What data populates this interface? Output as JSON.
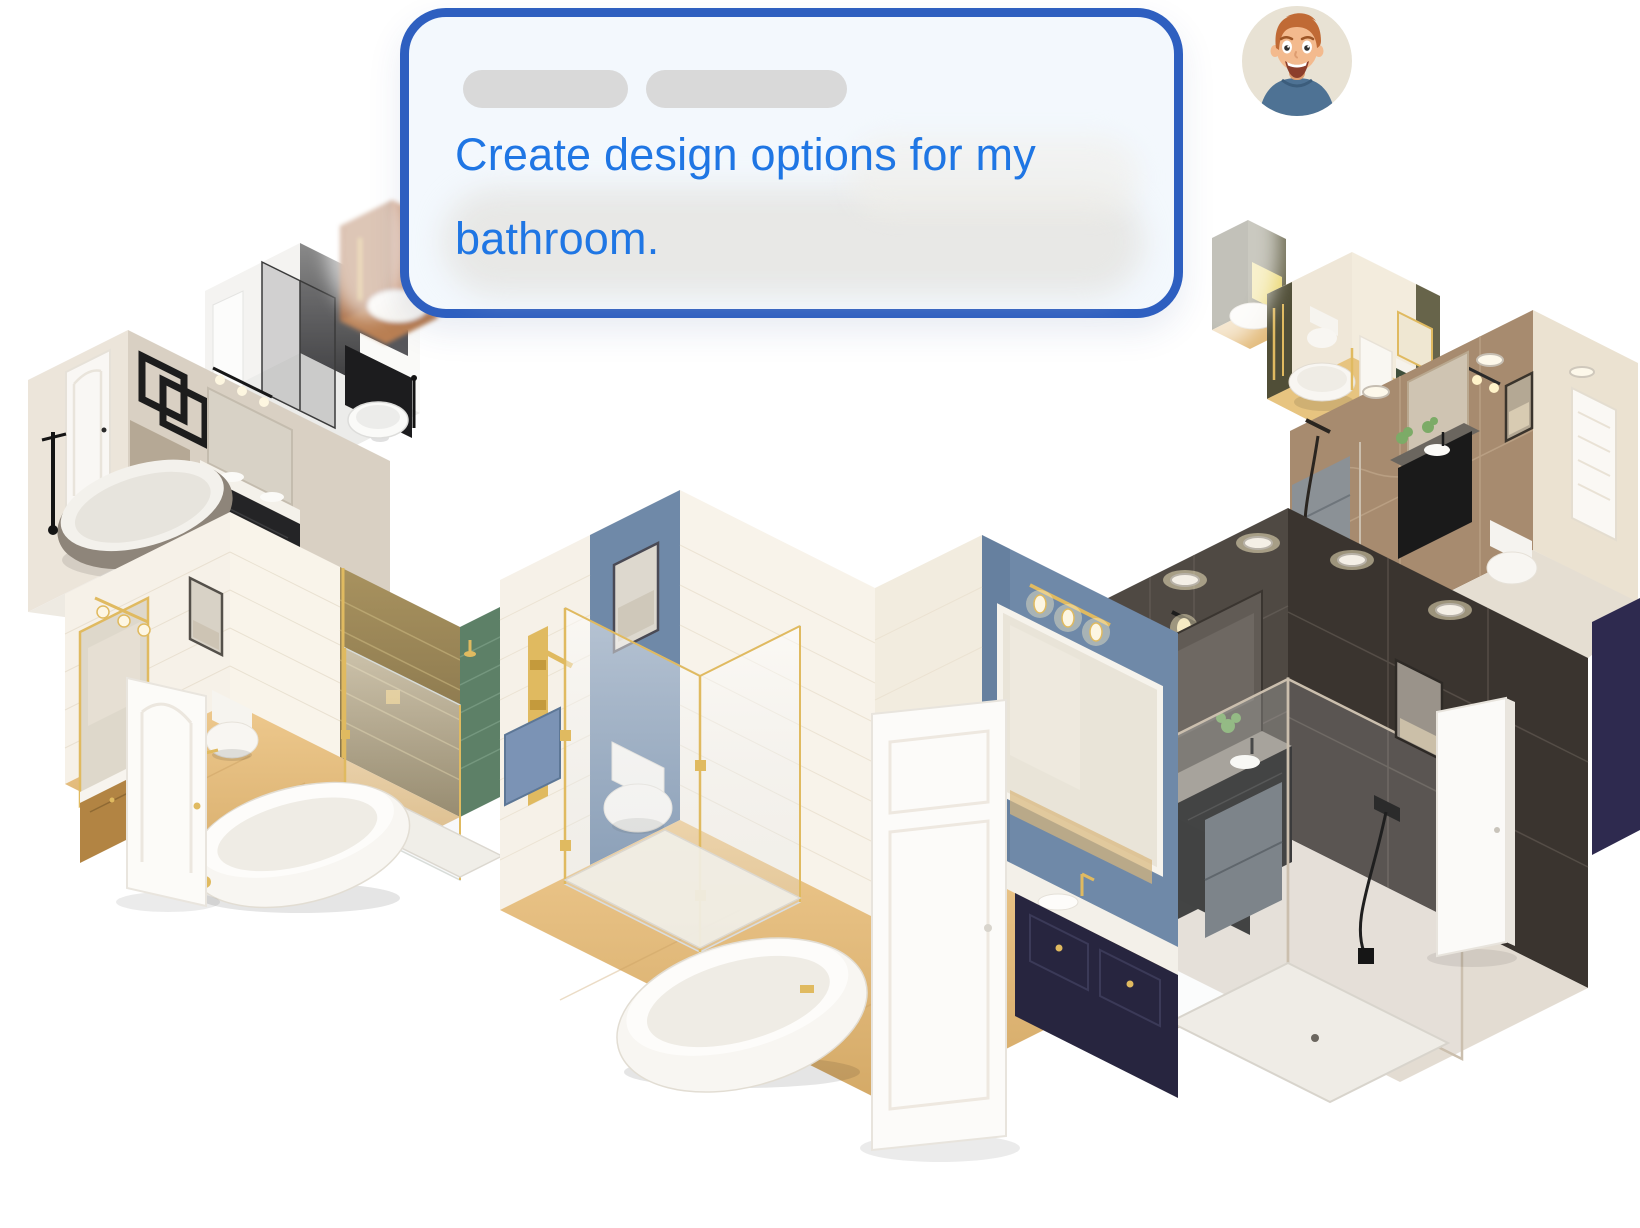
{
  "prompt_card": {
    "text": "Create design options for my bathroom."
  },
  "avatar": {
    "icon": "man-avatar-emoji"
  },
  "palette": {
    "bubble_border": "#2e5fc0",
    "bubble_bg": "#f3f8fd",
    "pill": "#d9d9d9",
    "prompt_text": "#1f76e4",
    "avatar_bg": "#e8e2d4",
    "avatar_hair": "#c06a35",
    "avatar_skin": "#f3ba8e",
    "avatar_skin_dark": "#dd9c70",
    "avatar_shirt": "#4e7294",
    "gold": "#e0ba60",
    "gold_deep": "#c49a3c",
    "wood": "#e3bb7b",
    "wood_dark": "#c9a05f",
    "white_wall": "#f6f1e8",
    "white_wall_dark": "#eae1d2",
    "cream": "#efe7d8",
    "taupe": "#d9d0c3",
    "taupe_dark": "#c9bfb0",
    "blue_wall": "#6f89a8",
    "blue_dark": "#5d7796",
    "navy": "#27253f",
    "green": "#5d8067",
    "green_dark": "#4a6a58",
    "olive": "#67644a",
    "olive_dark": "#504e37",
    "charcoal": "#4f4943",
    "charcoal_dark": "#3a342f",
    "marble": "#a78b6f",
    "marble_dark": "#907459",
    "terracotta": "#c98c66",
    "terracotta_dark": "#aa7049",
    "black": "#1b1b1b",
    "floor_light": "#e3dcd2",
    "floor_white": "#eeeae2",
    "tub": "#f8f6f2",
    "tub_shade": "#dcd6cb",
    "glass": "#eef1f3",
    "mirror": "#d9d3c6",
    "gray_cab": "#7e868c",
    "plant": "#7cab67",
    "light_warm": "#fff3c9",
    "purple": "#2e2a4f",
    "mono_dark": "#454547"
  }
}
